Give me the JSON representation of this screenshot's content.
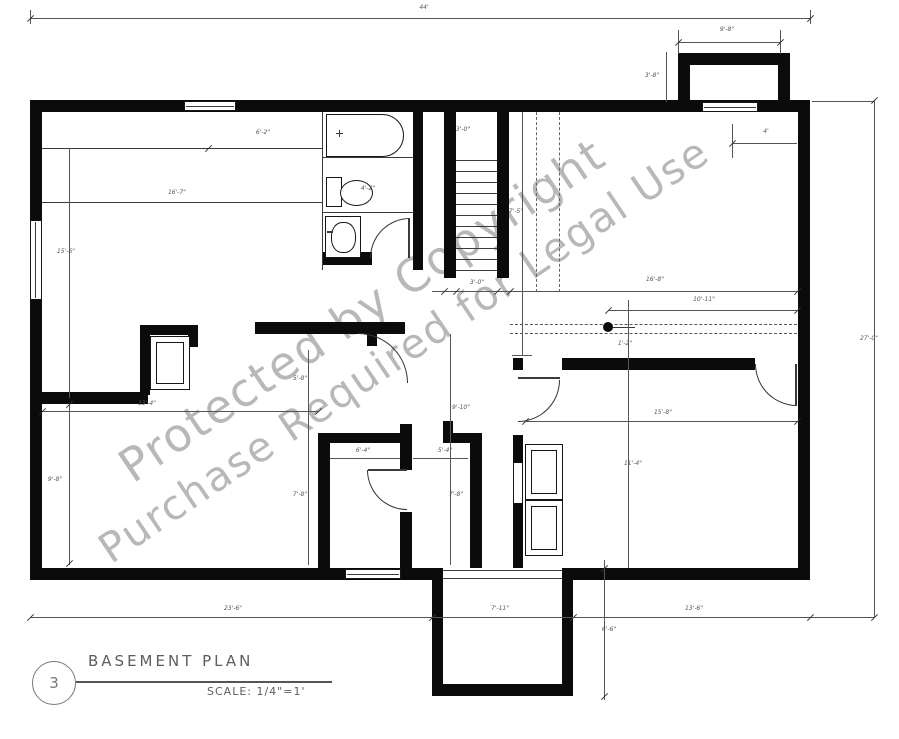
{
  "document_type": "architectural floor plan",
  "title_block": {
    "sheet_number": "3",
    "title": "BASEMENT PLAN",
    "scale": "SCALE: 1/4\"=1'"
  },
  "watermark": {
    "line1": "Protected by Copyright",
    "line2": "Purchase Required for Legal Use"
  },
  "colors": {
    "wall": "#0b0b0b",
    "dimension_text": "#555555",
    "watermark": "#7d7d7d"
  },
  "dimensions": [
    {
      "x": 424,
      "y": 8,
      "text": "44'"
    },
    {
      "x": 727,
      "y": 30,
      "text": "9'-8\""
    },
    {
      "x": 652,
      "y": 76,
      "text": "3'-8\""
    },
    {
      "x": 766,
      "y": 132,
      "text": "4'"
    },
    {
      "x": 263,
      "y": 133,
      "text": "6'-2\""
    },
    {
      "x": 177,
      "y": 193,
      "text": "16'-7\""
    },
    {
      "x": 368,
      "y": 189,
      "text": "4'-2\""
    },
    {
      "x": 463,
      "y": 130,
      "text": "3'-0\""
    },
    {
      "x": 66,
      "y": 252,
      "text": "15'-6\""
    },
    {
      "x": 516,
      "y": 212,
      "text": "7'-5\""
    },
    {
      "x": 655,
      "y": 280,
      "text": "16'-8\""
    },
    {
      "x": 704,
      "y": 300,
      "text": "10'-11\""
    },
    {
      "x": 625,
      "y": 344,
      "text": "1'-2\""
    },
    {
      "x": 477,
      "y": 283,
      "text": "3'-0\""
    },
    {
      "x": 300,
      "y": 379,
      "text": "5'-8\""
    },
    {
      "x": 461,
      "y": 408,
      "text": "9'-10\""
    },
    {
      "x": 147,
      "y": 404,
      "text": "13'-4\""
    },
    {
      "x": 55,
      "y": 480,
      "text": "9'-8\""
    },
    {
      "x": 363,
      "y": 451,
      "text": "6'-4\""
    },
    {
      "x": 445,
      "y": 451,
      "text": "5'-4\""
    },
    {
      "x": 300,
      "y": 495,
      "text": "7'-8\""
    },
    {
      "x": 456,
      "y": 495,
      "text": "7'-8\""
    },
    {
      "x": 663,
      "y": 413,
      "text": "15'-8\""
    },
    {
      "x": 633,
      "y": 464,
      "text": "11'-4\""
    },
    {
      "x": 869,
      "y": 339,
      "text": "27'-0\""
    },
    {
      "x": 233,
      "y": 609,
      "text": "23'-6\""
    },
    {
      "x": 500,
      "y": 609,
      "text": "7'-11\""
    },
    {
      "x": 694,
      "y": 609,
      "text": "13'-6\""
    },
    {
      "x": 609,
      "y": 630,
      "text": "6'-6\""
    }
  ]
}
